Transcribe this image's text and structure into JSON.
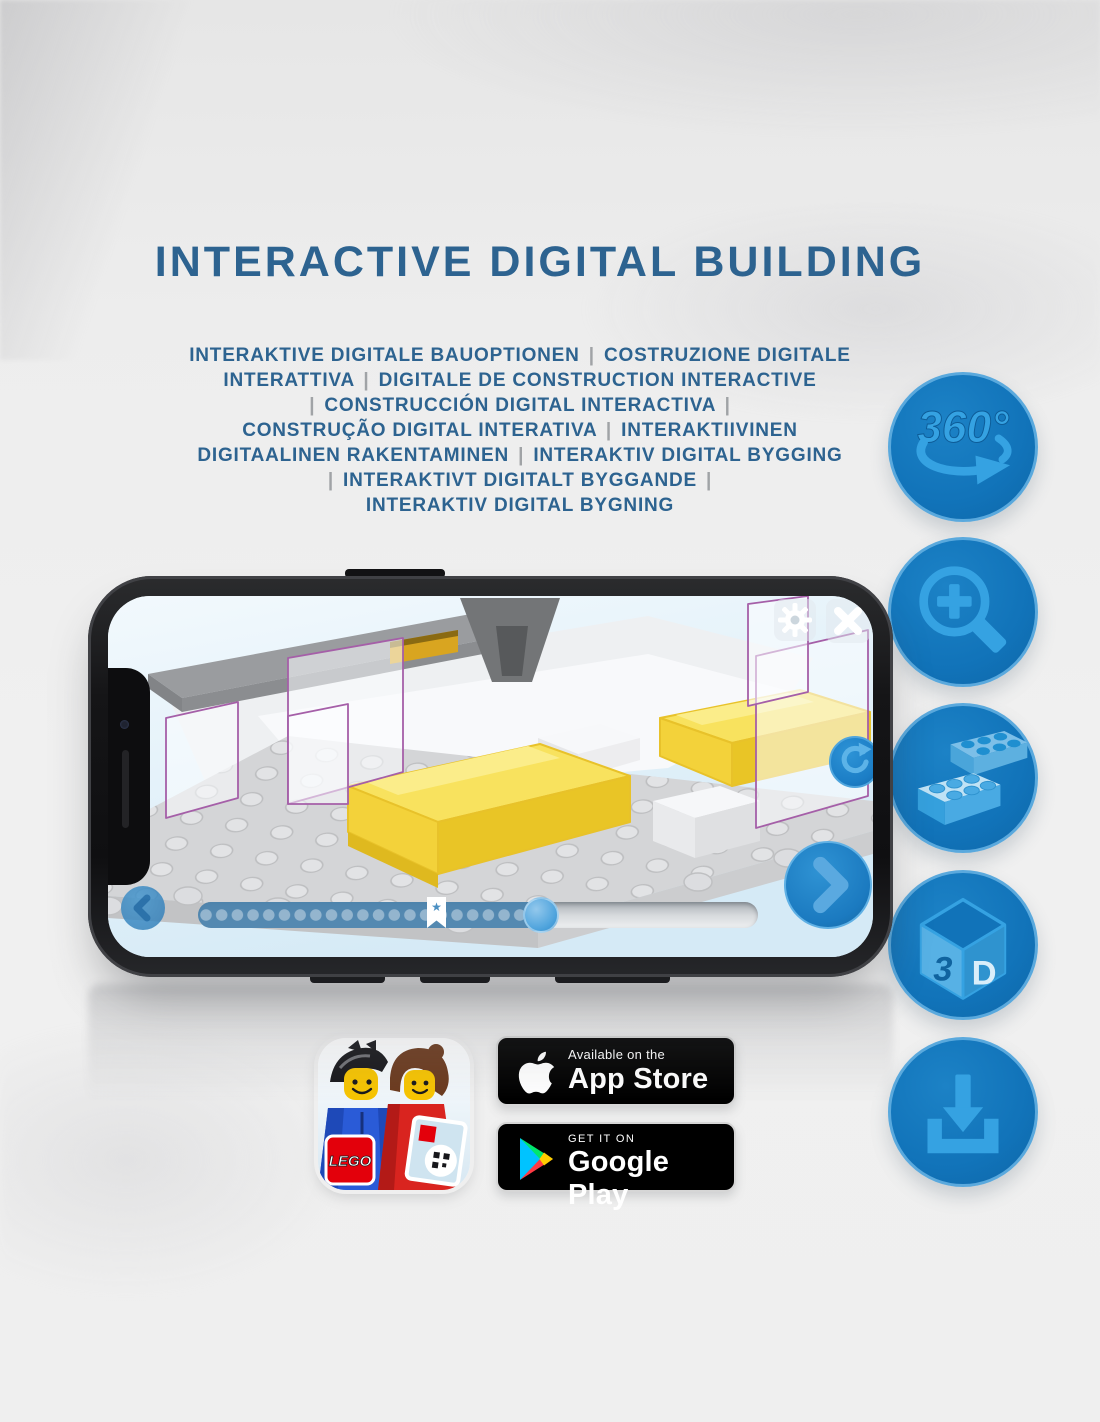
{
  "title": "INTERACTIVE DIGITAL BUILDING",
  "subtitle": {
    "lines": [
      "INTERAKTIVE DIGITALE BAUOPTIONEN | COSTRUZIONE DIGITALE",
      "INTERATTIVA | DIGITALE DE CONSTRUCTION INTERACTIVE",
      "| CONSTRUCCIÓN DIGITAL INTERACTIVA |",
      "CONSTRUÇÃO DIGITAL INTERATIVA | INTERAKTIIVINEN",
      "DIGITAALINEN RAKENTAMINEN | INTERAKTIV DIGITAL BYGGING",
      "| INTERAKTIVT DIGITALT BYGGANDE |",
      "INTERAKTIV DIGITAL BYGNING"
    ]
  },
  "feature_icons": {
    "rotate_360": {
      "label": "360°"
    },
    "zoom": {
      "name": "zoom-in"
    },
    "brick": {
      "name": "building-bricks"
    },
    "cube_3d": {
      "left": "3",
      "right": "D"
    },
    "download": {
      "name": "download"
    }
  },
  "phone_app": {
    "progress": {
      "percent_complete": 64,
      "bookmark_percent": 41,
      "star_glyph": "★"
    }
  },
  "store_badges": {
    "lego_app": {
      "logo_text": "LEGO"
    },
    "app_store": {
      "tagline": "Available on the",
      "name": "App Store"
    },
    "google_play": {
      "tagline": "GET IT ON",
      "name": "Google Play"
    }
  },
  "colors": {
    "heading_blue": "#2d6390",
    "icon_circle_blue": "#1173b9",
    "icon_glyph_blue": "#35a2e2",
    "ui_button_blue": "#1b7ac0",
    "lego_red": "#e3000b",
    "brick_yellow": "#f3d23a"
  }
}
